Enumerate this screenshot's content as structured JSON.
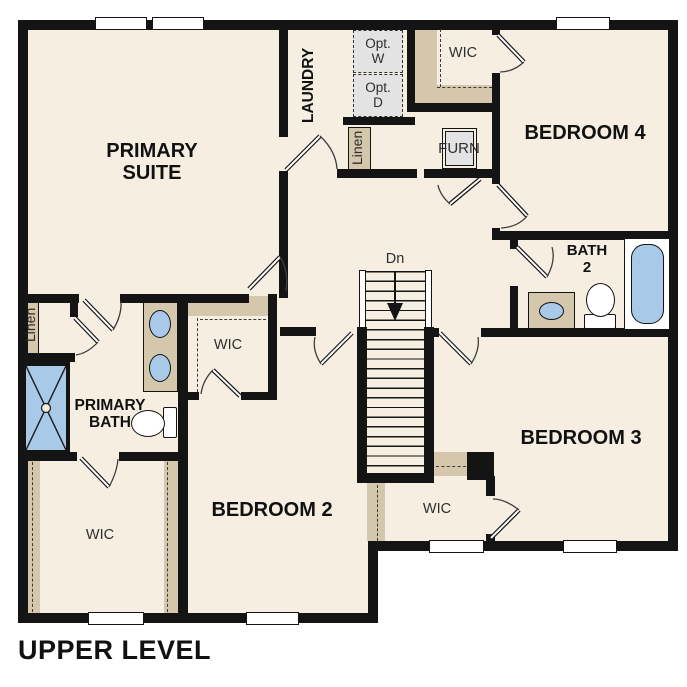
{
  "title": "UPPER LEVEL",
  "colors": {
    "floor": "#f6efe1",
    "wall": "#141414",
    "closet_tan": "#d4c7ab",
    "fixture_blue": "#a9c9e9",
    "appliance_gray": "#e3e3e3",
    "outside": "#ffffff",
    "label": "#111111",
    "secondary_label": "#2e2e2e"
  },
  "rooms": {
    "primary_suite": "PRIMARY\nSUITE",
    "laundry": "LAUNDRY",
    "bedroom_4": "BEDROOM 4",
    "bedroom_3": "BEDROOM 3",
    "bedroom_2": "BEDROOM 2",
    "bath_2": "BATH\n2",
    "primary_bath": "PRIMARY\nBATH",
    "wic_bedroom4": "WIC",
    "wic_bedroom2": "WIC",
    "wic_primary": "WIC",
    "wic_bedroom3": "WIC",
    "linen_hall": "Linen",
    "linen_primary": "Linen",
    "furnace": "FURN",
    "opt_washer": "Opt.\nW",
    "opt_dryer": "Opt.\nD",
    "stair_direction": "Dn"
  }
}
